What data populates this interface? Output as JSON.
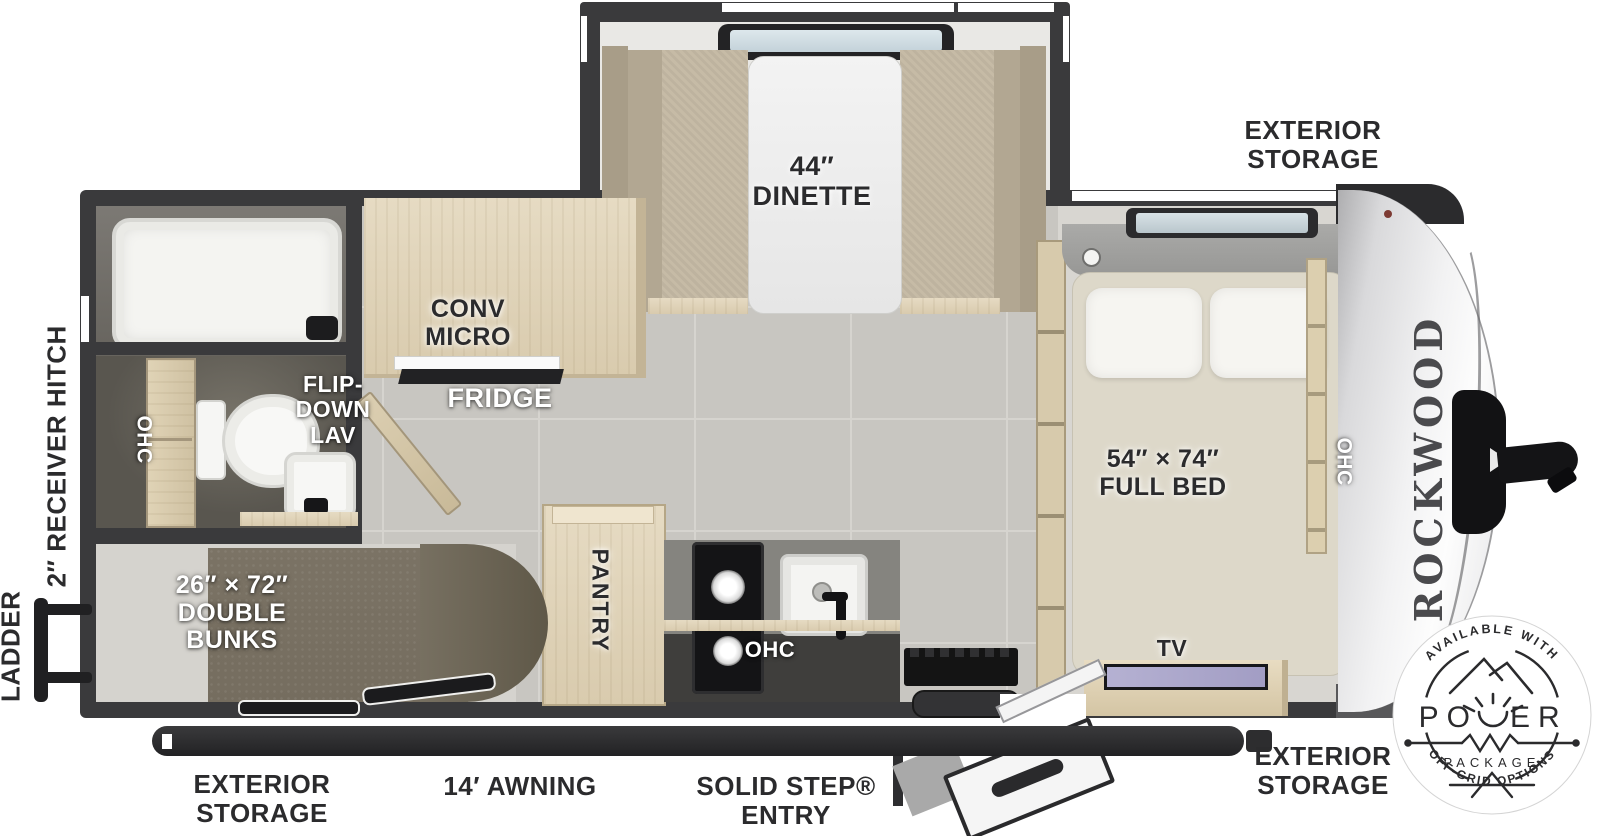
{
  "brand": {
    "name": "ROCKWOOD",
    "series": "GEO PRO"
  },
  "plan_labels": {
    "dinette": {
      "line1": "44″",
      "line2": "DINETTE"
    },
    "conv_micro": {
      "line1": "CONV",
      "line2": "MICRO"
    },
    "fridge": "FRIDGE",
    "flip_down_lav": {
      "line1": "FLIP-",
      "line2": "DOWN",
      "line3": "LAV"
    },
    "ohc_bath": "OHC",
    "ohc_kitchen": "OHC",
    "ohc_bed": "OHC",
    "pantry": "PANTRY",
    "double_bunks": {
      "line1": "26″ × 72″",
      "line2": "DOUBLE",
      "line3": "BUNKS"
    },
    "full_bed": {
      "line1": "54″ × 74″",
      "line2": "FULL BED"
    },
    "tv": "TV"
  },
  "exterior_labels": {
    "storage_front": {
      "line1": "EXTERIOR",
      "line2": "STORAGE"
    },
    "storage_rear": {
      "line1": "EXTERIOR",
      "line2": "STORAGE"
    },
    "storage_door_side": {
      "line1": "EXTERIOR",
      "line2": "STORAGE"
    },
    "awning": "14′ AWNING",
    "entry": {
      "line1": "SOLID STEP®",
      "line2": "ENTRY"
    },
    "receiver_hitch": "2″ RECEIVER HITCH",
    "ladder": "LADDER"
  },
  "badge": {
    "available_with": "AVAILABLE WITH",
    "power_prefix": "PO",
    "power_suffix": "ER",
    "power_word": "POWER",
    "package": "PACKAGE",
    "off_grid": "OFF-GRID OPTIONS"
  },
  "colors": {
    "wall": "#3a3a3c",
    "wood": "#e0d4ba",
    "floor_tile": "#c8c6c1",
    "bedroom_floor": "#d8d6d1",
    "carpet": "#7b7365",
    "cushion_fabric": "#c6bba6",
    "mattress": "#ddd8c9",
    "bath_floor": "#59564f",
    "front_cap": "#e9e9eb",
    "awning_bar": "#2d2d2f",
    "tv_screen": "#a9a5c9",
    "label_ink": "#2b2b2d"
  }
}
